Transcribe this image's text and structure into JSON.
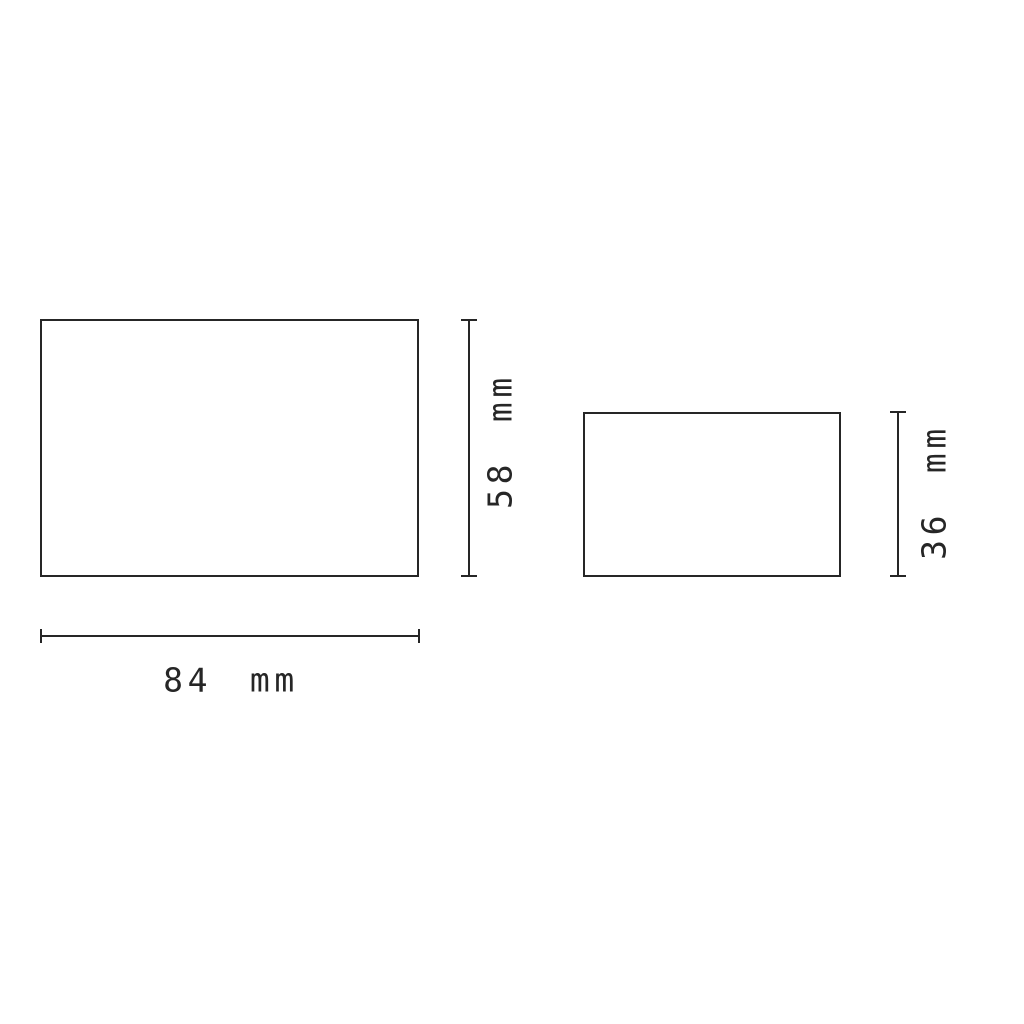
{
  "drawing": {
    "background_color": "#ffffff",
    "line_color": "#262626",
    "unit": "mm",
    "rectangles": [
      {
        "id": "large",
        "labeled_width_mm": 84,
        "labeled_height_mm": 58
      },
      {
        "id": "small",
        "labeled_height_mm": 36
      }
    ],
    "labels": {
      "large_height": "58 mm",
      "large_width": "84 mm",
      "small_height": "36 mm"
    }
  }
}
